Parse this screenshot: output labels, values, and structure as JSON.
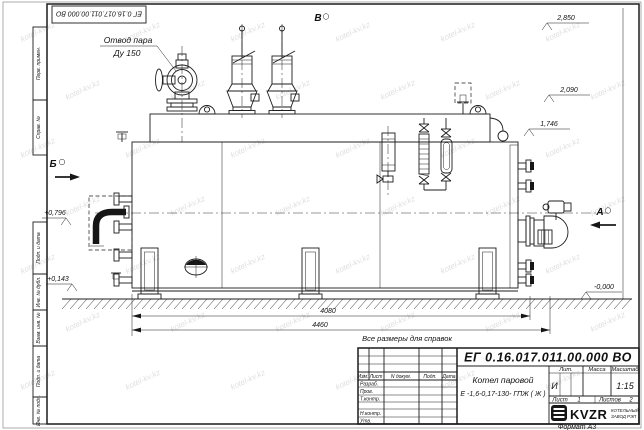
{
  "watermark": {
    "text": "kotel-kv.kz"
  },
  "page": {
    "doc_number_top": "ЕГ 0.16.017.011.00.000  ВО",
    "format_label": "Формат А3",
    "margin": {
      "perv_primen": "Перв. примен.",
      "sprav_no": "Справ. №",
      "podp_data_1": "Подп. и дата",
      "inv_dubl": "Инв. № дубл.",
      "vzam_inv": "Взам. инв. №",
      "podp_data_2": "Подп. и дата",
      "inv_podl": "Инв. № подл."
    }
  },
  "drawing": {
    "callout": {
      "line1": "Отвод пара",
      "line2": "Ду 150"
    },
    "views": {
      "a": "А",
      "b": "Б",
      "v": "В"
    },
    "elevations": {
      "e1": "2,850",
      "e2": "2,090",
      "e3": "1,746",
      "e4": "+0,796",
      "e5": "+0,143",
      "e6": "-0,000"
    },
    "dims": {
      "d1": "4080",
      "d2": "4460"
    },
    "note": "Все размеры для справок"
  },
  "title_block": {
    "doc_number": "ЕГ 0.16.017.011.00.000  ВО",
    "name_line1": "Котел паровой",
    "name_line2": "Е -1,6-0,17-130- ГПЖ ( Ж )",
    "cols": {
      "izm": "Изм.",
      "list": "Лист",
      "docum": "N докум.",
      "podp": "Подп.",
      "date": "Дата"
    },
    "rows": {
      "razrab": "Разраб.",
      "prov": "Пров.",
      "tkontr": "Т.контр.",
      "nkontr": "Н.контр.",
      "utv": "Утв."
    },
    "lit_label": "Лит.",
    "mass_label": "Масса",
    "scale_label": "Масштаб",
    "lit_value": "И",
    "scale_value": "1:15",
    "sheet_label": "Лист",
    "sheet_value": "1",
    "sheets_label": "Листов",
    "sheets_value": "2",
    "logo": {
      "text": "KVZR",
      "sub1": "КОТЕЛЬНЫЙ",
      "sub2": "ЗАВОД РЭП"
    }
  }
}
